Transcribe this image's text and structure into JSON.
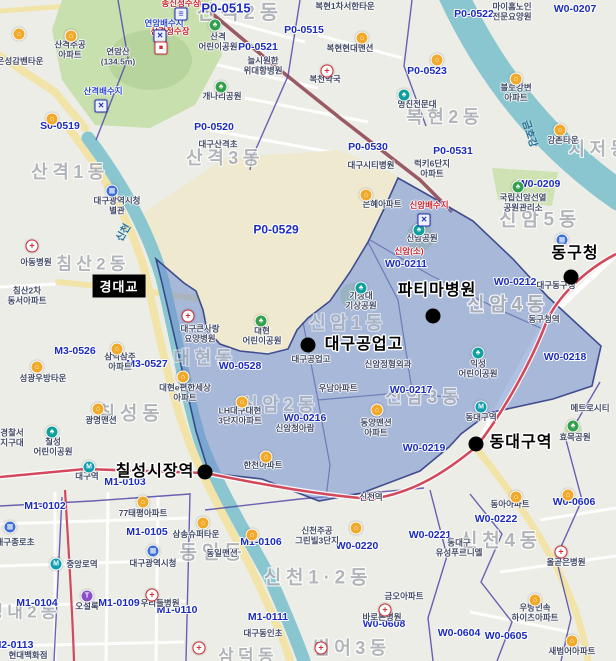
{
  "colors": {
    "overlay_fill": "#6f8ccd",
    "overlay_border": "#2a357f",
    "zone_code_text": "#1b2bbf",
    "river": "#8ac6d0",
    "park": "#c8dfae",
    "campus": "#efe9cf",
    "subway_line1": "#d2495c",
    "railway": "#9a5a64",
    "boundary": "#5348a8",
    "road_major": "#f2e4a9"
  },
  "layers": {
    "districts": [
      {
        "t": "산격2동",
        "x": 240,
        "y": 13,
        "s": 20
      },
      {
        "t": "산격1동",
        "x": 70,
        "y": 172,
        "s": 18
      },
      {
        "t": "산격3동",
        "x": 225,
        "y": 158,
        "s": 18
      },
      {
        "t": "복현2동",
        "x": 445,
        "y": 117,
        "s": 18
      },
      {
        "t": "지저동",
        "x": 600,
        "y": 149,
        "s": 18
      },
      {
        "t": "신암5동",
        "x": 540,
        "y": 220,
        "s": 19
      },
      {
        "t": "신암4동",
        "x": 508,
        "y": 305,
        "s": 19
      },
      {
        "t": "신암1동",
        "x": 348,
        "y": 323,
        "s": 18,
        "o": 0.55
      },
      {
        "t": "신암2동",
        "x": 280,
        "y": 405,
        "s": 18,
        "o": 0.6
      },
      {
        "t": "신암3동",
        "x": 424,
        "y": 397,
        "s": 18,
        "o": 0.7
      },
      {
        "t": "대현동",
        "x": 205,
        "y": 358,
        "s": 18,
        "o": 0.6
      },
      {
        "t": "침산2동",
        "x": 93,
        "y": 264,
        "s": 17
      },
      {
        "t": "칠성동",
        "x": 131,
        "y": 414,
        "s": 19
      },
      {
        "t": "동인동",
        "x": 213,
        "y": 553,
        "s": 19
      },
      {
        "t": "신천1·2동",
        "x": 318,
        "y": 578,
        "s": 19
      },
      {
        "t": "신천4동",
        "x": 501,
        "y": 541,
        "s": 19
      },
      {
        "t": "범어3동",
        "x": 352,
        "y": 648,
        "s": 18
      },
      {
        "t": "성내2동",
        "x": 24,
        "y": 612,
        "s": 17
      },
      {
        "t": "삼덕동",
        "x": 248,
        "y": 656,
        "s": 17
      }
    ],
    "zones": [
      {
        "t": "P0-0515",
        "x": 226,
        "y": 9,
        "s": 13
      },
      {
        "t": "P0-0515",
        "x": 304,
        "y": 31
      },
      {
        "t": "P0-0521",
        "x": 258,
        "y": 48
      },
      {
        "t": "P0-0522",
        "x": 474,
        "y": 15
      },
      {
        "t": "W0-0207",
        "x": 575,
        "y": 10
      },
      {
        "t": "P0-0523",
        "x": 427,
        "y": 72
      },
      {
        "t": "P0-0520",
        "x": 214,
        "y": 128
      },
      {
        "t": "S0-0519",
        "x": 60,
        "y": 127
      },
      {
        "t": "P0-0529",
        "x": 276,
        "y": 230,
        "s": 12
      },
      {
        "t": "P0-0530",
        "x": 368,
        "y": 148
      },
      {
        "t": "P0-0531",
        "x": 453,
        "y": 152
      },
      {
        "t": "W0-0209",
        "x": 539,
        "y": 185
      },
      {
        "t": "W0-0211",
        "x": 406,
        "y": 265
      },
      {
        "t": "W0-0212",
        "x": 515,
        "y": 283
      },
      {
        "t": "W0-0218",
        "x": 565,
        "y": 358
      },
      {
        "t": "W0-0217",
        "x": 411,
        "y": 391
      },
      {
        "t": "W0-0216",
        "x": 305,
        "y": 419
      },
      {
        "t": "W0-0528",
        "x": 240,
        "y": 367
      },
      {
        "t": "M3-0526",
        "x": 75,
        "y": 352
      },
      {
        "t": "M3-0527",
        "x": 147,
        "y": 365
      },
      {
        "t": "W0-0219",
        "x": 424,
        "y": 449
      },
      {
        "t": "W0-0220",
        "x": 357,
        "y": 547
      },
      {
        "t": "W0-0222",
        "x": 496,
        "y": 520
      },
      {
        "t": "W0-0221",
        "x": 430,
        "y": 536
      },
      {
        "t": "W0-0606",
        "x": 574,
        "y": 503
      },
      {
        "t": "W0-0608",
        "x": 384,
        "y": 625
      },
      {
        "t": "W0-0604",
        "x": 459,
        "y": 634
      },
      {
        "t": "W0-0605",
        "x": 506,
        "y": 637
      },
      {
        "t": "M1-0102",
        "x": 45,
        "y": 507
      },
      {
        "t": "M1-0105",
        "x": 147,
        "y": 533
      },
      {
        "t": "M1-0103",
        "x": 125,
        "y": 483
      },
      {
        "t": "M1-0104",
        "x": 37,
        "y": 604
      },
      {
        "t": "M1-0109",
        "x": 119,
        "y": 604
      },
      {
        "t": "M1-0110",
        "x": 177,
        "y": 611
      },
      {
        "t": "M2-0113",
        "x": 13,
        "y": 646
      },
      {
        "t": "M1-0106",
        "x": 261,
        "y": 543
      },
      {
        "t": "M1-0111",
        "x": 268,
        "y": 618
      }
    ],
    "places": [
      {
        "t": "산격주공\n아파트",
        "x": 70,
        "y": 50
      },
      {
        "t": "연암산\n(134.5m)",
        "x": 118,
        "y": 57
      },
      {
        "t": "은성감벤타운",
        "x": 20,
        "y": 62
      },
      {
        "t": "산격\n어린이공원",
        "x": 218,
        "y": 42
      },
      {
        "t": "늘시원한\n위대항병원",
        "x": 263,
        "y": 66
      },
      {
        "t": "복현1차서한타운",
        "x": 345,
        "y": 7
      },
      {
        "t": "복현현대맨션",
        "x": 350,
        "y": 49
      },
      {
        "t": "복천약국",
        "x": 325,
        "y": 80
      },
      {
        "t": "개나리공원",
        "x": 222,
        "y": 97
      },
      {
        "t": "대구산격초",
        "x": 218,
        "y": 145
      },
      {
        "t": "마이홈노인\n전문요양원",
        "x": 512,
        "y": 12
      },
      {
        "t": "불로강변\n아파트",
        "x": 516,
        "y": 93
      },
      {
        "t": "강촌타운",
        "x": 563,
        "y": 141
      },
      {
        "t": "영진전문대",
        "x": 417,
        "y": 105
      },
      {
        "t": "대구광역시청\n별관",
        "x": 117,
        "y": 206
      },
      {
        "t": "아동병원",
        "x": 36,
        "y": 263
      },
      {
        "t": "침산2차\n동서아파트",
        "x": 27,
        "y": 296
      },
      {
        "t": "대구시티병원",
        "x": 371,
        "y": 166
      },
      {
        "t": "은혜아파트",
        "x": 382,
        "y": 205
      },
      {
        "t": "럭키6단지\n아파트",
        "x": 432,
        "y": 169
      },
      {
        "t": "국립신암선열\n공원관리소",
        "x": 523,
        "y": 203
      },
      {
        "t": "신암공원",
        "x": 422,
        "y": 239
      },
      {
        "t": "기상대\n기상공원",
        "x": 361,
        "y": 301
      },
      {
        "t": "대구동구청",
        "x": 556,
        "y": 286
      },
      {
        "t": "동구청역",
        "x": 544,
        "y": 320
      },
      {
        "t": "대구큰사랑\n요양병원",
        "x": 200,
        "y": 334
      },
      {
        "t": "대현\n어린이공원",
        "x": 262,
        "y": 336
      },
      {
        "t": "대현e편한세상\n아파트",
        "x": 185,
        "y": 393
      },
      {
        "t": "대구공업고",
        "x": 311,
        "y": 360
      },
      {
        "t": "신암정형외과",
        "x": 388,
        "y": 365
      },
      {
        "t": "우남아파트",
        "x": 338,
        "y": 389
      },
      {
        "t": "LH대구대현\n3단지아파트",
        "x": 240,
        "y": 416
      },
      {
        "t": "신암청아람",
        "x": 295,
        "y": 429
      },
      {
        "t": "동양맨션\n아파트",
        "x": 376,
        "y": 428
      },
      {
        "t": "한천아파트",
        "x": 263,
        "y": 466
      },
      {
        "t": "익성\n어린이공원",
        "x": 478,
        "y": 369
      },
      {
        "t": "동대구역",
        "x": 481,
        "y": 418
      },
      {
        "t": "효목공원",
        "x": 575,
        "y": 438
      },
      {
        "t": "메트로시티",
        "x": 590,
        "y": 409
      },
      {
        "t": "동아아파트",
        "x": 510,
        "y": 505
      },
      {
        "t": "동대구\n유성푸르니엘",
        "x": 459,
        "y": 548
      },
      {
        "t": "올곧은병원",
        "x": 566,
        "y": 563
      },
      {
        "t": "우방민속\n하이츠아파트",
        "x": 535,
        "y": 613
      },
      {
        "t": "새범어아파트",
        "x": 572,
        "y": 652
      },
      {
        "t": "신천주공\n그린빌3단지",
        "x": 317,
        "y": 536
      },
      {
        "t": "신천역",
        "x": 371,
        "y": 498
      },
      {
        "t": "금오아파트",
        "x": 404,
        "y": 597
      },
      {
        "t": "바로본병원",
        "x": 382,
        "y": 618
      },
      {
        "t": "대구동인초",
        "x": 263,
        "y": 634
      },
      {
        "t": "동일맨션",
        "x": 222,
        "y": 554
      },
      {
        "t": "삼송슈퍼타운",
        "x": 196,
        "y": 535
      },
      {
        "t": "77태평아파트",
        "x": 143,
        "y": 514
      },
      {
        "t": "대구광역시청",
        "x": 153,
        "y": 564
      },
      {
        "t": "중앙로역",
        "x": 82,
        "y": 565
      },
      {
        "t": "대구종로초",
        "x": 15,
        "y": 543
      },
      {
        "t": "우리들병원",
        "x": 160,
        "y": 604
      },
      {
        "t": "오설록",
        "x": 87,
        "y": 607
      },
      {
        "t": "현대백화점",
        "x": 28,
        "y": 656
      },
      {
        "t": "성광우방타운",
        "x": 43,
        "y": 379
      },
      {
        "t": "삼익삼주\n아파트",
        "x": 120,
        "y": 362
      },
      {
        "t": "광명맨션",
        "x": 101,
        "y": 421
      },
      {
        "t": "대구역",
        "x": 87,
        "y": 477
      },
      {
        "t": "칠성\n어린이공원",
        "x": 53,
        "y": 447
      },
      {
        "t": "경찰서\n지구대",
        "x": 12,
        "y": 438
      },
      {
        "t": "송신정수장",
        "x": 181,
        "y": 4,
        "cl": "red"
      },
      {
        "t": "산격정수장",
        "x": 170,
        "y": 32,
        "cl": "red"
      },
      {
        "t": "신암배수지",
        "x": 429,
        "y": 206,
        "cl": "red"
      },
      {
        "t": "신암(소)",
        "x": 409,
        "y": 252,
        "cl": "red"
      },
      {
        "t": "연암배수지",
        "x": 164,
        "y": 24,
        "cl": "bluefac"
      },
      {
        "t": "산격배수지",
        "x": 103,
        "y": 92,
        "cl": "bluefac"
      }
    ],
    "waters": [
      {
        "t": "신천",
        "x": 124,
        "y": 233,
        "r": -60
      },
      {
        "t": "금호강",
        "x": 529,
        "y": 134,
        "r": 72
      }
    ],
    "icons": [
      {
        "k": "apt",
        "x": 71,
        "y": 36
      },
      {
        "k": "apt",
        "x": 19,
        "y": 34
      },
      {
        "k": "apt",
        "x": 52,
        "y": 119
      },
      {
        "k": "apt",
        "x": 362,
        "y": 38
      },
      {
        "k": "apt",
        "x": 437,
        "y": 60
      },
      {
        "k": "apt",
        "x": 516,
        "y": 79
      },
      {
        "k": "apt",
        "x": 560,
        "y": 130
      },
      {
        "k": "apt",
        "x": 366,
        "y": 195
      },
      {
        "k": "apt",
        "x": 117,
        "y": 349
      },
      {
        "k": "apt",
        "x": 37,
        "y": 367
      },
      {
        "k": "apt",
        "x": 98,
        "y": 409
      },
      {
        "k": "apt",
        "x": 183,
        "y": 377
      },
      {
        "k": "apt",
        "x": 242,
        "y": 402
      },
      {
        "k": "apt",
        "x": 377,
        "y": 410
      },
      {
        "k": "apt",
        "x": 266,
        "y": 457
      },
      {
        "k": "apt",
        "x": 143,
        "y": 502
      },
      {
        "k": "apt",
        "x": 203,
        "y": 523
      },
      {
        "k": "apt",
        "x": 252,
        "y": 535
      },
      {
        "k": "apt",
        "x": 356,
        "y": 528
      },
      {
        "k": "apt",
        "x": 516,
        "y": 497
      },
      {
        "k": "apt",
        "x": 568,
        "y": 495
      },
      {
        "k": "apt",
        "x": 535,
        "y": 600
      },
      {
        "k": "apt",
        "x": 572,
        "y": 641
      },
      {
        "k": "park",
        "x": 215,
        "y": 25
      },
      {
        "k": "park",
        "x": 221,
        "y": 87
      },
      {
        "k": "park",
        "x": 261,
        "y": 321
      },
      {
        "k": "park",
        "x": 518,
        "y": 187
      },
      {
        "k": "park",
        "x": 573,
        "y": 426
      },
      {
        "k": "tpark",
        "x": 52,
        "y": 432
      },
      {
        "k": "tpark",
        "x": 419,
        "y": 230
      },
      {
        "k": "tpark",
        "x": 361,
        "y": 288
      },
      {
        "k": "tpark",
        "x": 478,
        "y": 353
      },
      {
        "k": "tpark",
        "x": 404,
        "y": 95
      },
      {
        "k": "gov",
        "x": 112,
        "y": 191
      },
      {
        "k": "gov",
        "x": 562,
        "y": 240
      },
      {
        "k": "gov",
        "x": 153,
        "y": 551
      },
      {
        "k": "gov",
        "x": 10,
        "y": 527
      },
      {
        "k": "med",
        "x": 327,
        "y": 71
      },
      {
        "k": "med",
        "x": 32,
        "y": 246
      },
      {
        "k": "med",
        "x": 188,
        "y": 316
      },
      {
        "k": "med",
        "x": 152,
        "y": 595
      },
      {
        "k": "med",
        "x": 385,
        "y": 610
      },
      {
        "k": "med",
        "x": 561,
        "y": 552
      },
      {
        "k": "med",
        "x": 321,
        "y": 648
      },
      {
        "k": "med",
        "x": 199,
        "y": 648
      },
      {
        "k": "metro",
        "x": 89,
        "y": 467
      },
      {
        "k": "metro",
        "x": 56,
        "y": 564
      },
      {
        "k": "metro",
        "x": 481,
        "y": 407
      },
      {
        "k": "store",
        "x": 87,
        "y": 596
      },
      {
        "k": "xbox",
        "x": 101,
        "y": 106
      },
      {
        "k": "xbox",
        "x": 424,
        "y": 220
      },
      {
        "k": "xbox",
        "x": 160,
        "y": 36
      },
      {
        "k": "levels",
        "x": 181,
        "y": 14
      },
      {
        "k": "redbox",
        "x": 161,
        "y": 48
      }
    ],
    "pois": [
      {
        "t": "동구청",
        "x": 575,
        "y": 254,
        "dx": 571,
        "dy": 277
      },
      {
        "t": "파티마병원",
        "x": 437,
        "y": 291,
        "dx": 433,
        "dy": 316
      },
      {
        "t": "대구공업고",
        "x": 364,
        "y": 345,
        "dx": 308,
        "dy": 345
      },
      {
        "t": "동대구역",
        "x": 521,
        "y": 443,
        "dx": 476,
        "dy": 444
      },
      {
        "t": "칠성시장역",
        "x": 155,
        "y": 472,
        "dx": 205,
        "dy": 472
      }
    ],
    "bridge": {
      "t": "경대교",
      "x": 119,
      "y": 286
    }
  }
}
